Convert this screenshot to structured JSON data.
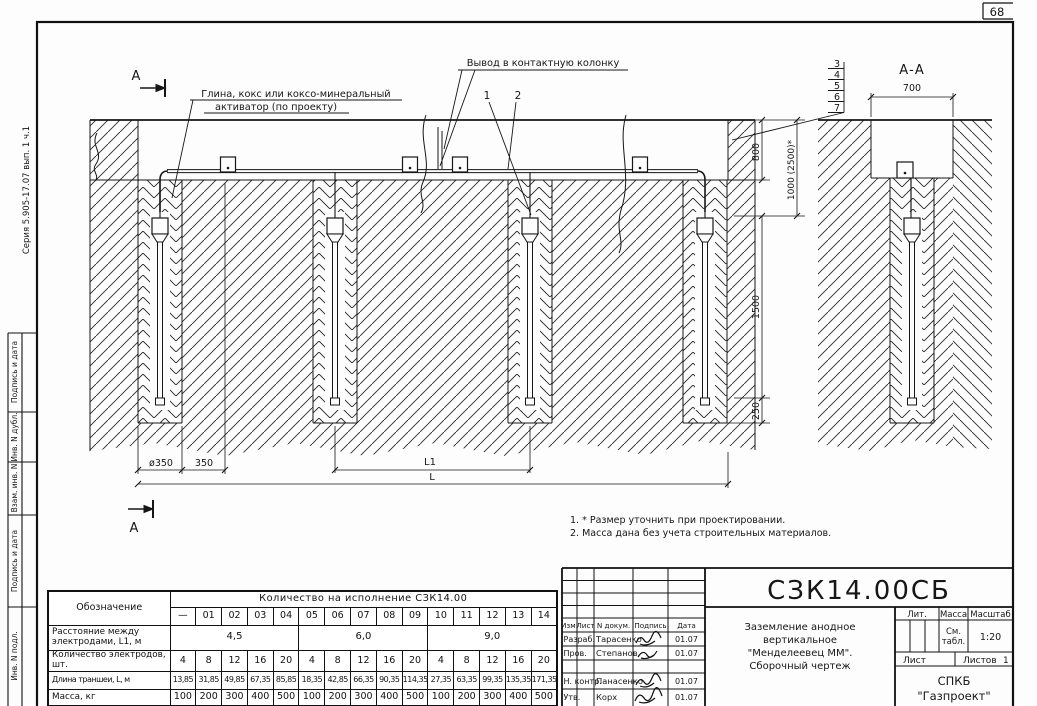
{
  "page": {
    "sheet_number": "68",
    "series_label": "Серия 5.905-17.07 вып. 1 ч.1"
  },
  "margin_labels": [
    "Подпись и дата",
    "Инв. N дубл.",
    "Взам. инв. N",
    "Подпись и дата",
    "Инв. N подл."
  ],
  "drawing": {
    "labels": {
      "activator_l1": "Глина, кокс или коксо-минеральный",
      "activator_l2": "активатор (по проекту)",
      "contact_note": "Вывод в контактную колонку",
      "section_letter_top": "А",
      "section_letter_bottom": "А",
      "section_view_title": "А-А",
      "callout_1": "1",
      "callout_2": "2",
      "stack": [
        "3",
        "4",
        "5",
        "6",
        "7"
      ]
    },
    "dimensions": {
      "d700": "700",
      "d800": "800",
      "d1000": "1000 (2500)*",
      "d1500": "1500",
      "d250": "250",
      "dia350": "ø350",
      "d350": "350",
      "l1": "L1",
      "l": "L"
    },
    "notes": [
      "1. * Размер уточнить при проектировании.",
      "2. Масса дана без учета строительных материалов."
    ]
  },
  "spec_table": {
    "col_header_designation": "Обозначение",
    "col_header_quantity": "Количество на исполнение СЗК14.00",
    "exec_cols": [
      "—",
      "01",
      "02",
      "03",
      "04",
      "05",
      "06",
      "07",
      "08",
      "09",
      "10",
      "11",
      "12",
      "13",
      "14"
    ],
    "rows": {
      "spacing": {
        "label": "Расстояние между электродами, L1, м",
        "values": [
          "4,5",
          "6,0",
          "9,0"
        ]
      },
      "count": {
        "label": "Количество электродов, шт.",
        "values": [
          "4",
          "8",
          "12",
          "16",
          "20",
          "4",
          "8",
          "12",
          "16",
          "20",
          "4",
          "8",
          "12",
          "16",
          "20"
        ]
      },
      "length": {
        "label": "Длина траншеи, L, м",
        "values": [
          "13,85",
          "31,85",
          "49,85",
          "67,35",
          "85,85",
          "18,35",
          "42,85",
          "66,35",
          "90,35",
          "114,35",
          "27,35",
          "63,35",
          "99,35",
          "135,35",
          "171,35"
        ]
      },
      "mass": {
        "label": "Масса, кг",
        "values": [
          "100",
          "200",
          "300",
          "400",
          "500",
          "100",
          "200",
          "300",
          "400",
          "500",
          "100",
          "200",
          "300",
          "400",
          "500"
        ]
      }
    }
  },
  "title_block": {
    "doc_number": "СЗК14.00СБ",
    "title_l1": "Заземление анодное",
    "title_l2": "вертикальное",
    "title_l3": "\"Менделеевец ММ\".",
    "title_l4": "Сборочный чертеж",
    "header": {
      "izm": "Изм.",
      "list": "Лист",
      "ndoc": "N докум.",
      "sign": "Подпись",
      "date": "Дата"
    },
    "rows": [
      {
        "role": "Разраб.",
        "name": "Тарасенко",
        "date": "01.07"
      },
      {
        "role": "Пров.",
        "name": "Степанов",
        "date": "01.07"
      },
      {
        "role": "Н. контр.",
        "name": "Панасенко",
        "date": "01.07"
      },
      {
        "role": "Утв.",
        "name": "Корх",
        "date": "01.07"
      }
    ],
    "lit_label": "Лит.",
    "mass_label": "Масса",
    "scale_label": "Масштаб",
    "mass_value_l1": "См.",
    "mass_value_l2": "табл.",
    "scale_value": "1:20",
    "sheet_label": "Лист",
    "sheets_label": "Листов",
    "sheets_value": "1",
    "org_l1": "СПКБ",
    "org_l2": "\"Газпроект\""
  }
}
